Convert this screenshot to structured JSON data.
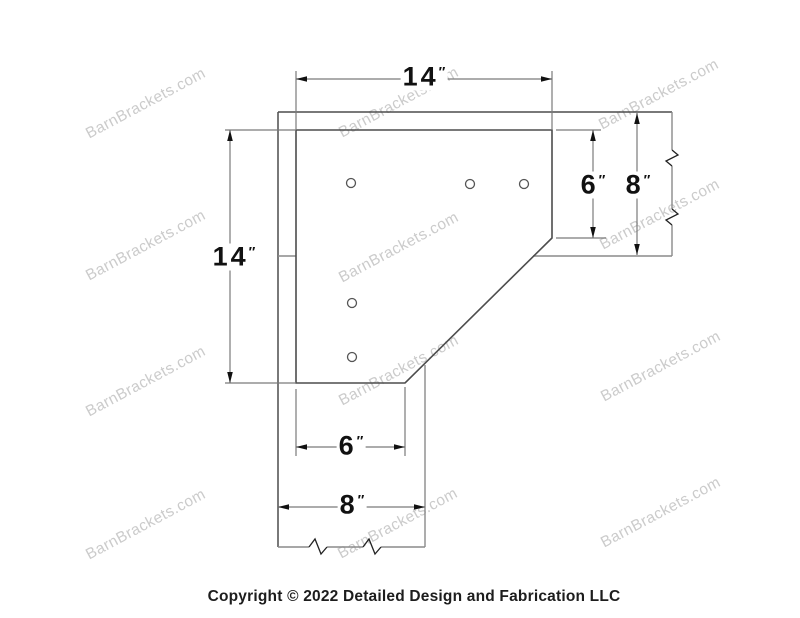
{
  "watermark": {
    "text": "BarnBrackets.com"
  },
  "dimensions": {
    "top_plate_width": {
      "value": "14",
      "unit": "″"
    },
    "left_plate_height": {
      "value": "14",
      "unit": "″"
    },
    "right_plate_leg": {
      "value": "6",
      "unit": "″"
    },
    "right_beam_height": {
      "value": "8",
      "unit": "″"
    },
    "bottom_plate_leg": {
      "value": "6",
      "unit": "″"
    },
    "bottom_post_width": {
      "value": "8",
      "unit": "″"
    }
  },
  "footer": {
    "copyright": "Copyright © 2022 Detailed Design and Fabrication LLC"
  }
}
